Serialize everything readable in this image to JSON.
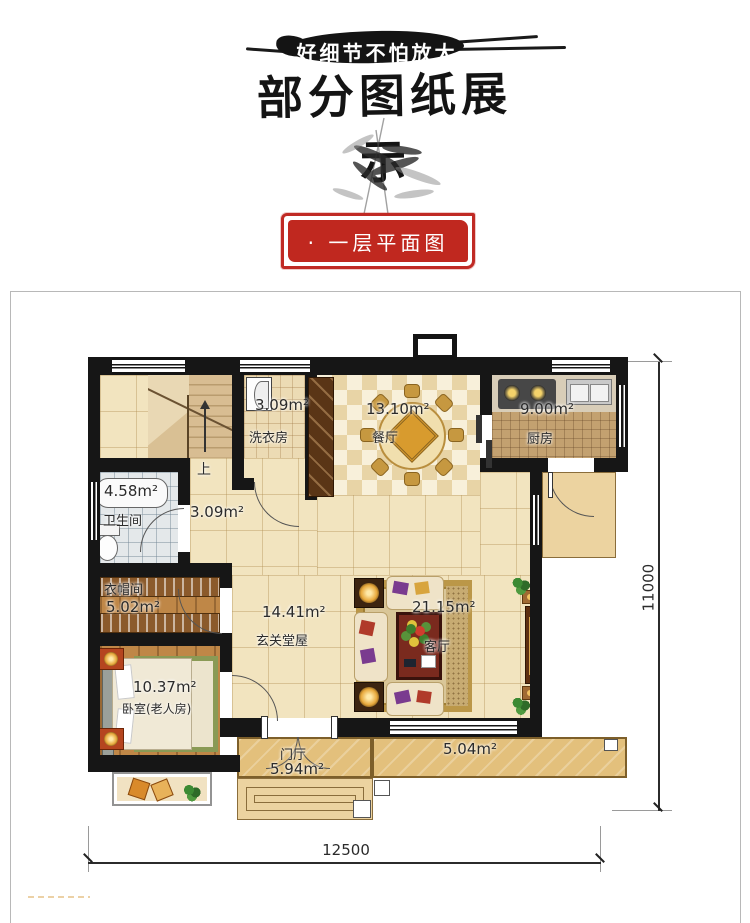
{
  "header": {
    "banner_text": "好细节不怕放大",
    "title": "部分图纸展示"
  },
  "stamp": {
    "label": "· 一层平面图"
  },
  "plan": {
    "rooms": {
      "stairs": {
        "label": "上"
      },
      "laundry": {
        "name": "洗衣房",
        "area": "3.09m²"
      },
      "dining": {
        "name": "餐厅",
        "area": "13.10m²"
      },
      "kitchen": {
        "name": "厨房",
        "area": "9.00m²"
      },
      "bathroom": {
        "name": "卫生间",
        "area": "4.58m²"
      },
      "corridor": {
        "area": "3.09m²"
      },
      "cloakroom": {
        "name": "衣帽间",
        "area": "5.02m²"
      },
      "hall": {
        "name": "玄关堂屋",
        "area": "14.41m²"
      },
      "living": {
        "name": "客厅",
        "area": "21.15m²"
      },
      "bedroom": {
        "name": "卧室(老人房)",
        "area": "10.37m²"
      },
      "foyer": {
        "name": "门厅",
        "area": "5.94m²"
      },
      "terrace": {
        "area": "5.04m²"
      }
    },
    "dimensions": {
      "width": "12500",
      "height": "11000"
    }
  },
  "colors": {
    "stamp_red": "#c0281f",
    "wall_black": "#161616"
  }
}
